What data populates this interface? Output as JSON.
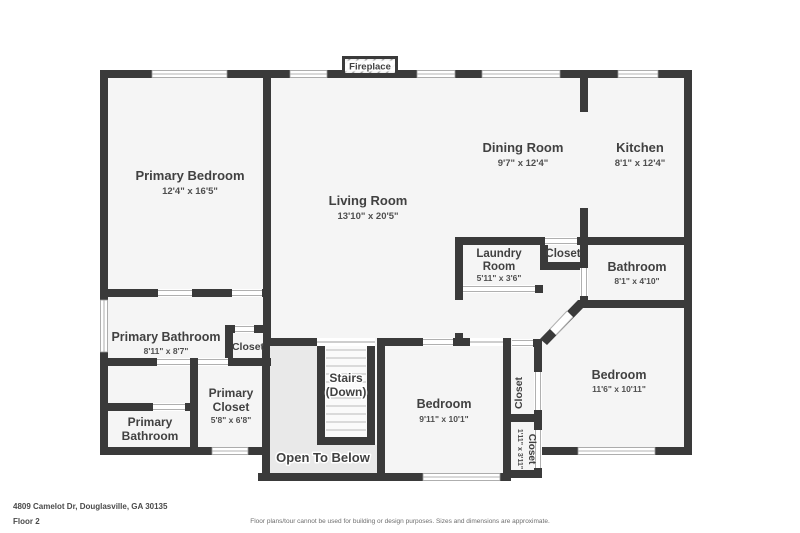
{
  "palette": {
    "page_bg": "#ffffff",
    "wall": "#3a3a3a",
    "floor": "#f5f5f5",
    "open_area": "#e9e9e9",
    "stairs_fill": "#fafafa",
    "step_line": "#c6c6c6",
    "window_line": "#9a9a9a",
    "door_line": "#b0b0b0",
    "label": "#414141",
    "dim_label": "#4f4f4f",
    "footer_text": "#4a4a4a",
    "disclaimer": "#6e6e6e"
  },
  "fireplace": {
    "label": "Fireplace"
  },
  "rooms": {
    "primary_bedroom": {
      "name": "Primary Bedroom",
      "dims": "12'4\" x 16'5\""
    },
    "living_room": {
      "name": "Living Room",
      "dims": "13'10\" x 20'5\""
    },
    "dining_room": {
      "name": "Dining Room",
      "dims": "9'7\" x 12'4\""
    },
    "kitchen": {
      "name": "Kitchen",
      "dims": "8'1\" x 12'4\""
    },
    "laundry_room": {
      "line1": "Laundry",
      "line2": "Room",
      "dims": "5'11\" x 3'6\""
    },
    "laundry_closet": {
      "name": "Closet"
    },
    "bathroom": {
      "name": "Bathroom",
      "dims": "8'1\" x 4'10\""
    },
    "primary_bathroom": {
      "name": "Primary Bathroom",
      "dims": "8'11\" x 8'7\""
    },
    "hall_closet": {
      "name": "Closet"
    },
    "primary_closet": {
      "line1": "Primary",
      "line2": "Closet",
      "dims": "5'8\" x 6'8\""
    },
    "primary_bathroom_2": {
      "line1": "Primary",
      "line2": "Bathroom"
    },
    "stairs": {
      "line1": "Stairs",
      "line2": "(Down)"
    },
    "open_to_below": {
      "name": "Open To Below"
    },
    "bedroom_1": {
      "name": "Bedroom",
      "dims": "9'11\" x 10'1\""
    },
    "bedroom_2": {
      "name": "Bedroom",
      "dims": "11'6\" x 10'11\""
    },
    "bedroom_2_closet_upper": {
      "name": "Closet"
    },
    "bedroom_2_closet_lower": {
      "name": "Closet",
      "dims": "1'11\" x 3'11\""
    }
  },
  "footer": {
    "address": "4809 Camelot Dr, Douglasville, GA 30135",
    "floor": "Floor 2",
    "disclaimer": "Floor plans/tour cannot be used for building or design purposes. Sizes and dimensions are approximate."
  }
}
